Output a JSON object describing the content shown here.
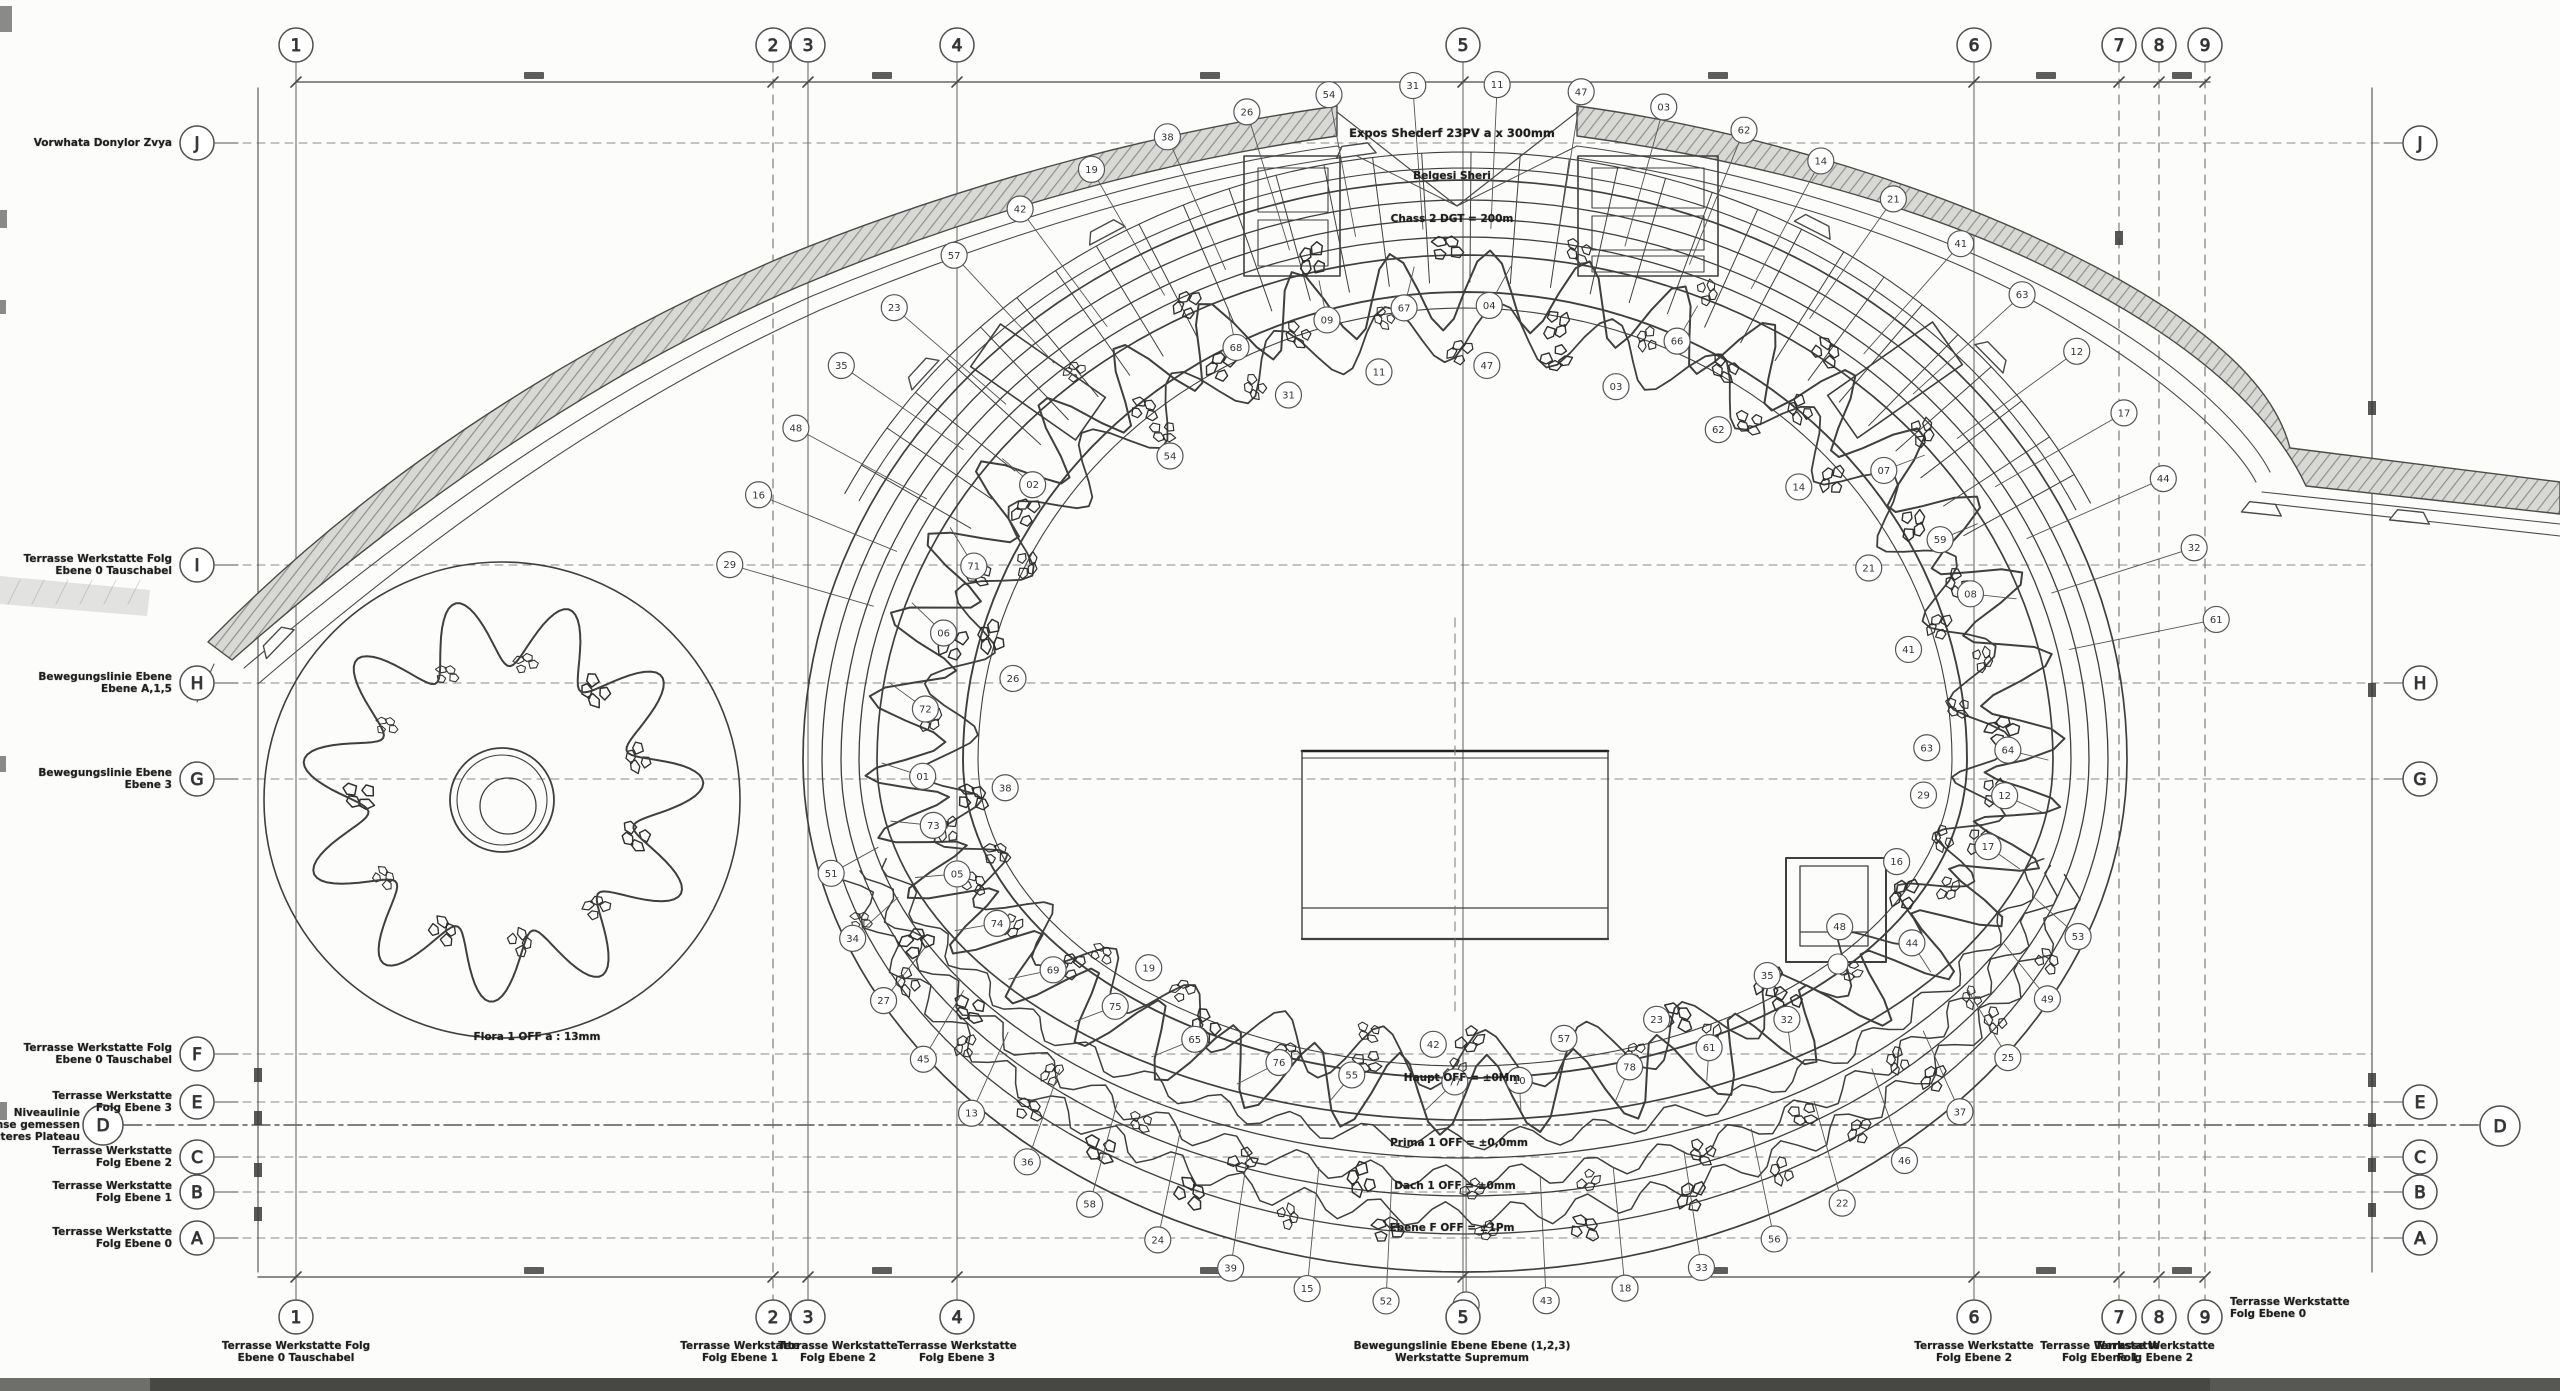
{
  "colors": {
    "line": "#3f3f3f",
    "grid": "#8a8a8a",
    "hatch_fill": "#d8d8d5",
    "hatch_line": "#8f8f8c",
    "text": "#1e1e1e",
    "footer_band": "#474744"
  },
  "grid": {
    "columns": [
      {
        "label": "1",
        "x": 296,
        "style": "solid"
      },
      {
        "label": "2",
        "x": 773,
        "style": "dashed"
      },
      {
        "label": "3",
        "x": 808,
        "style": "solid"
      },
      {
        "label": "4",
        "x": 957,
        "style": "solid"
      },
      {
        "label": "5",
        "x": 1463,
        "style": "solid"
      },
      {
        "label": "6",
        "x": 1974,
        "style": "solid"
      },
      {
        "label": "7",
        "x": 2119,
        "style": "dashed"
      },
      {
        "label": "8",
        "x": 2159,
        "style": "dashed"
      },
      {
        "label": "9",
        "x": 2205,
        "style": "dashed"
      }
    ],
    "rows": [
      {
        "label": "J",
        "y": 143,
        "left": true,
        "right": true,
        "extended": false
      },
      {
        "label": "I",
        "y": 565,
        "left": true,
        "right": false,
        "extended": false
      },
      {
        "label": "H",
        "y": 683,
        "left": true,
        "right": true,
        "extended": false
      },
      {
        "label": "G",
        "y": 779,
        "left": true,
        "right": true,
        "extended": false
      },
      {
        "label": "F",
        "y": 1054,
        "left": true,
        "right": false,
        "extended": false
      },
      {
        "label": "E",
        "y": 1102,
        "left": true,
        "right": true,
        "extended": false
      },
      {
        "label": "D",
        "y": 1125,
        "left": true,
        "right": true,
        "extended": true
      },
      {
        "label": "C",
        "y": 1157,
        "left": true,
        "right": true,
        "extended": false
      },
      {
        "label": "B",
        "y": 1192,
        "left": true,
        "right": true,
        "extended": false
      },
      {
        "label": "A",
        "y": 1238,
        "left": true,
        "right": true,
        "extended": false
      }
    ]
  },
  "row_labels": {
    "J": "Vorwhata Donylor Zvya",
    "I": "Terrasse Werkstatte Folg\nEbene 0 Tauschabel",
    "H": "Bewegungslinie Ebene\nEbene A,1,5",
    "G": "Bewegungslinie Ebene\nEbene 3",
    "F": "Terrasse Werkstatte Folg\nEbene 0 Tauschabel",
    "E": "Terrasse Werkstatte\nFolg Ebene 3",
    "D": "Niveaulinie\nRegelachse gemessen\nunteres Plateau",
    "C": "Terrasse Werkstatte\nFolg Ebene 2",
    "B": "Terrasse Werkstatte\nFolg Ebene 1",
    "A": "Terrasse Werkstatte\nFolg Ebene 0"
  },
  "column_footnotes": [
    {
      "col": "1",
      "x": 296,
      "text": "Terrasse Werkstatte Folg\nEbene 0 Tauschabel"
    },
    {
      "col": "2",
      "x": 740,
      "text": "Terrasse Werkstatte\nFolg Ebene 1"
    },
    {
      "col": "3",
      "x": 838,
      "text": "Terrasse Werkstatte\nFolg Ebene 2"
    },
    {
      "col": "4",
      "x": 957,
      "text": "Terrasse Werkstatte\nFolg Ebene 3"
    },
    {
      "col": "5",
      "x": 1462,
      "text": "Bewegungslinie Ebene Ebene (1,2,3)\nWerkstatte Supremum"
    },
    {
      "col": "6",
      "x": 1974,
      "text": "Terrasse Werkstatte\nFolg Ebene 2"
    },
    {
      "col": "7",
      "x": 2100,
      "text": "Terrasse Werkstatte\nFolg Ebene 1"
    },
    {
      "col": "8",
      "x": 2155,
      "text": "Terrasse Werkstatte\nFolg Ebene 2"
    }
  ],
  "annotations": {
    "top_line1": "Expos Shederf 23PV a x 300mm",
    "top_line2": "Belgesi Sheri",
    "top_line3": "Chass 2 DGT = 200m",
    "levels": [
      "Haupt OFF = ±0Mm",
      "Prima 1 OFF = ±0,0mm",
      "Dach 1 OFF = ±0mm",
      "Ebene F OFF = ±1Pm"
    ],
    "round_building": "Flora 1 OFF a : 13mm",
    "footnote_right_of_9": "Terrasse Werkstatte\nFolg Ebene 0"
  },
  "callouts": {
    "numbers": [
      "61",
      "32",
      "44",
      "17",
      "12",
      "63",
      "41",
      "21",
      "14",
      "62",
      "03",
      "47",
      "11",
      "31",
      "54",
      "26",
      "38",
      "19",
      "42",
      "57",
      "23",
      "35",
      "48",
      "16",
      "29",
      "51",
      "34",
      "27",
      "45",
      "13",
      "36",
      "58",
      "24",
      "39",
      "15",
      "52",
      "28",
      "43",
      "18",
      "33",
      "56",
      "22",
      "46",
      "37",
      "25",
      "49",
      "53",
      "64",
      "08",
      "59",
      "07",
      "66",
      "04",
      "67",
      "09",
      "68",
      "02",
      "71",
      "06",
      "72",
      "01",
      "73",
      "05",
      "74",
      "69",
      "75",
      "65",
      "76",
      "55",
      "77",
      "10",
      "78"
    ]
  }
}
